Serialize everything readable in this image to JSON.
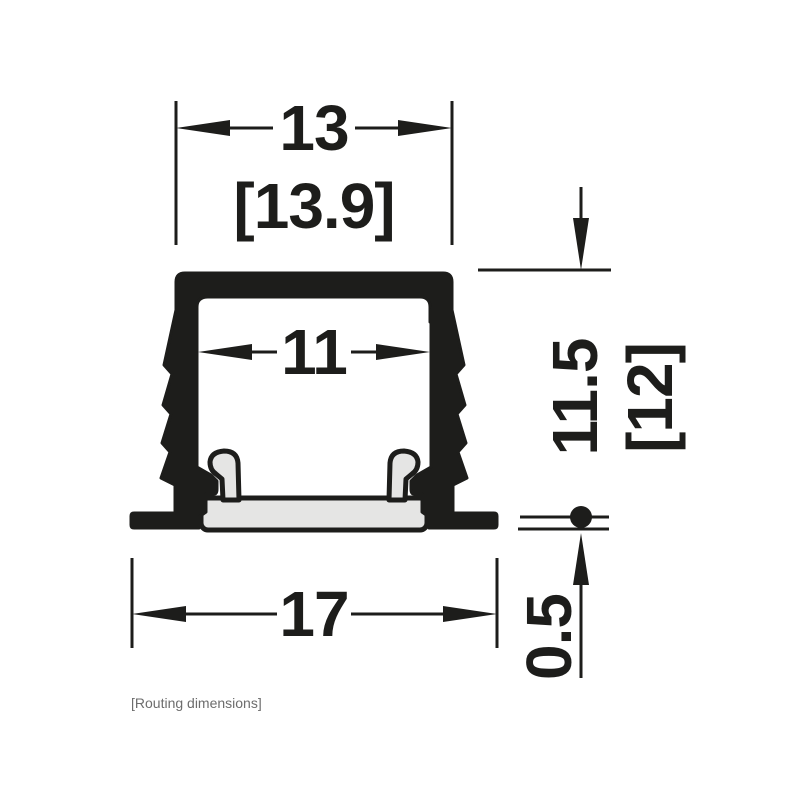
{
  "drawing": {
    "caption": "[Routing dimensions]",
    "dims": {
      "routing_width": "13",
      "overall_width_bracket": "[13.9]",
      "inner_width": "11",
      "routing_depth": "11.5",
      "overall_height_bracket": "[12]",
      "lip_protrusion": "0.5",
      "flange_width": "17"
    },
    "colors": {
      "line": "#1d1d1b",
      "cover_fill": "#e5e5e4",
      "caption_text": "#6d6d6d",
      "background": "#ffffff"
    }
  }
}
